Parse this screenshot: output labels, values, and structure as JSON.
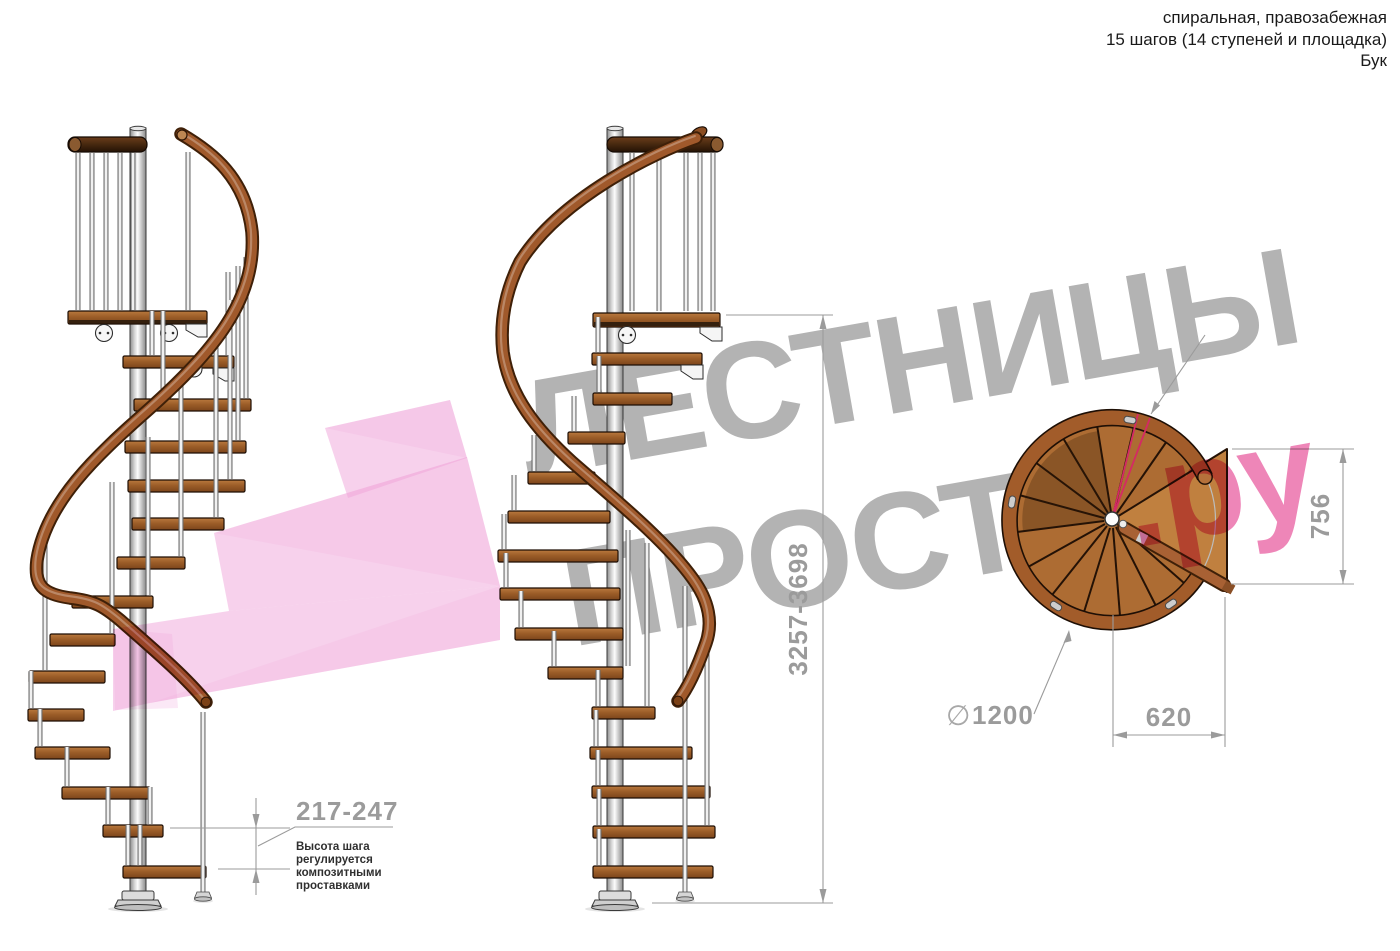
{
  "header": {
    "line1": "спиральная, правозабежная",
    "line2": "15 шагов (14 ступеней и площадка)",
    "line3": "Бук"
  },
  "watermark": {
    "line1": "ЛЕСТНИЦЫ",
    "line2_gray": "ПРОСТО",
    "line2_pink": ".ру"
  },
  "dimensions": {
    "total_height": "3257-3698",
    "step_height": "217-247",
    "step_height_note": [
      "Высота шага",
      "регулируется",
      "композитными",
      "проставками"
    ],
    "landing_depth": "756",
    "landing_width": "620",
    "diameter_symbol": "∅",
    "diameter_value": "1200"
  },
  "colors": {
    "wm_gray": "#b3b3b3",
    "wm_pink": "#ee86b8",
    "arrow_pink": "#efa3da",
    "dim_gray": "#9b9b9b",
    "note_ink": "#2f2f2f",
    "ink": "#1a1a1a",
    "rail_wood": "#a0592b",
    "step_wood": "#a96a31",
    "red_marker": "#d42a64"
  }
}
